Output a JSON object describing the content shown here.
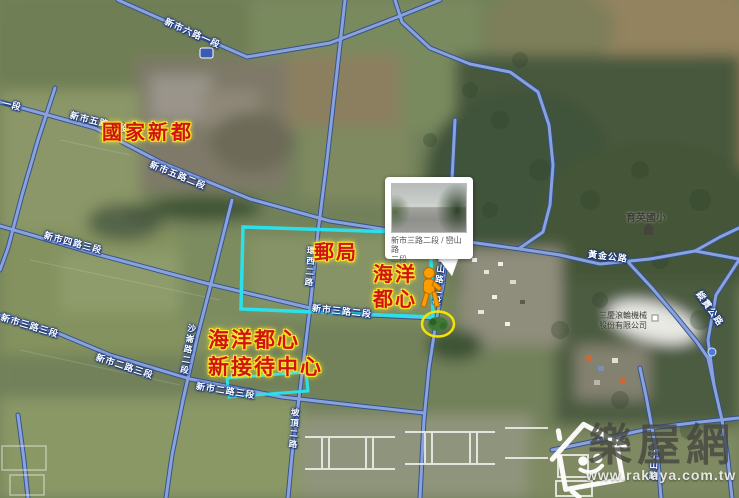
{
  "annotations": {
    "national_new_town": "國家新都",
    "post_office": "郵局",
    "ocean_center_line1": "海洋",
    "ocean_center_line2": "都心",
    "reception_line1": "海洋都心",
    "reception_line2": "新接待中心"
  },
  "road_labels": [
    {
      "text": "新市六路一段"
    },
    {
      "text": "一段"
    },
    {
      "text": "新市五路二段"
    },
    {
      "text": "新市五路二段"
    },
    {
      "text": "新市四路三段"
    },
    {
      "text": "新市三路三段"
    },
    {
      "text": "新市二路三段"
    },
    {
      "text": "新市二路三段"
    },
    {
      "text": "新市三路二段"
    },
    {
      "text": "環西二路"
    },
    {
      "text": "沙崙路二段"
    },
    {
      "text": "巒山路二段"
    },
    {
      "text": "坡頂二路"
    },
    {
      "text": "中山路"
    },
    {
      "text": "黃金公路"
    },
    {
      "text": "縱貫公路"
    }
  ],
  "streetview_popup": {
    "caption_line1": "新市三路二段 / 巒山路",
    "caption_line2": "二段"
  },
  "pois": {
    "school": "育英國小",
    "company_line1": "三慶滾輪機械",
    "company_line2": "股份有限公司"
  },
  "watermark": {
    "brand": "樂屋網",
    "url": "www.rakuya.com.tw"
  },
  "colors": {
    "road_fill": "#8aa2dc",
    "road_casing": "#33518f",
    "annotation_red": "#d01414",
    "annotation_glow": "#ffe92a",
    "highlight_cyan": "#2be0ea",
    "pegman_orange": "#ff9d00",
    "streetview_ring_yellow": "#f2e400",
    "watermark_gray": "#44443f"
  }
}
